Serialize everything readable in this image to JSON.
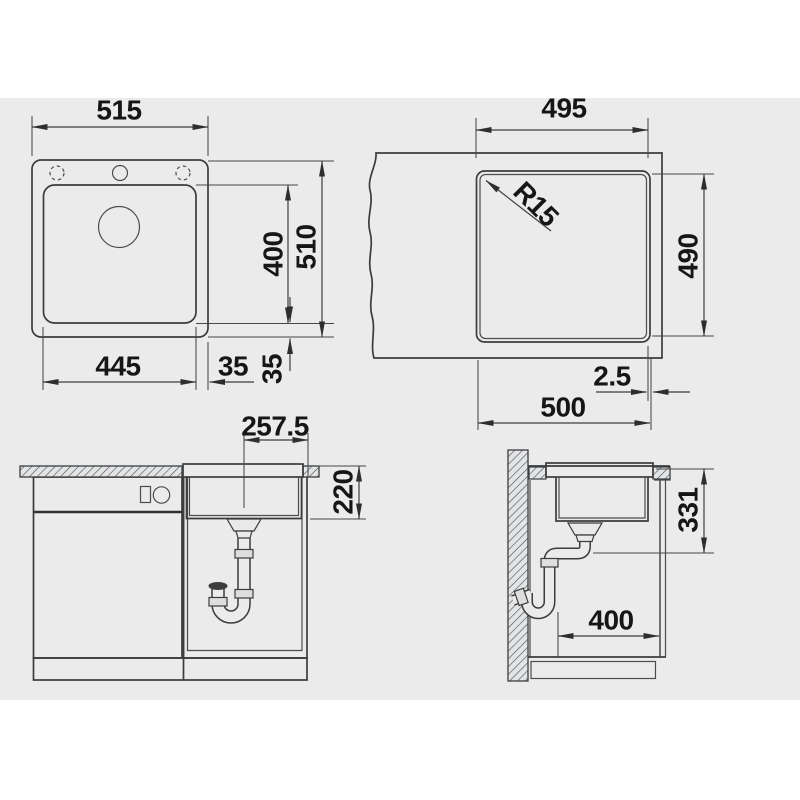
{
  "colors": {
    "page_bg": "#ffffff",
    "canvas_bg": "#ebebeb",
    "counter_fill": "#d8dadb",
    "sink_fill": "#fbfbfb",
    "cutout_fill": "#fcfcfc",
    "line": "#3a3c3e",
    "dim_line": "#3c3e40",
    "text": "#161616"
  },
  "sink_plan": {
    "overall_width": "515",
    "bowl_width": "445",
    "right_margin": "35",
    "bottom_margin": "35",
    "bowl_length": "400",
    "overall_length": "510"
  },
  "cutout_plan": {
    "cutout_width_top": "495",
    "corner_radius": "R15",
    "cutout_length": "490",
    "rim_offset": "2.5",
    "cutout_width_bottom": "500"
  },
  "front_view": {
    "center_to_edge": "257.5",
    "bowl_depth": "220"
  },
  "side_view": {
    "outlet_height": "331",
    "wall_clearance": "400"
  }
}
